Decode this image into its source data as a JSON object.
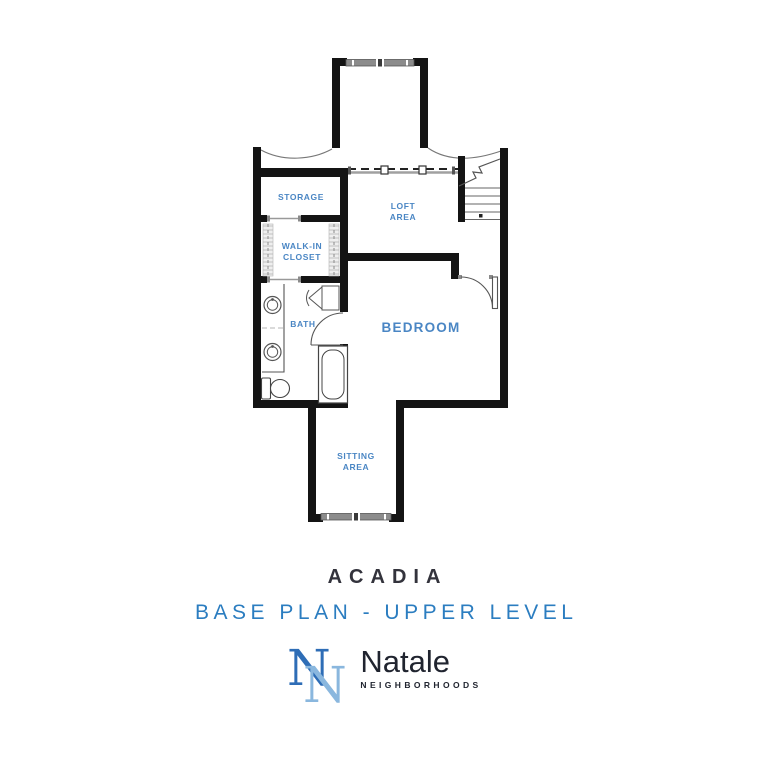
{
  "plan": {
    "rooms": {
      "storage": {
        "label": "STORAGE"
      },
      "loft": {
        "line1": "LOFT",
        "line2": "AREA"
      },
      "walk_in_closet": {
        "line1": "WALK-IN",
        "line2": "CLOSET"
      },
      "bath": {
        "label": "BATH"
      },
      "bedroom": {
        "label": "BEDROOM"
      },
      "sitting": {
        "line1": "SITTING",
        "line2": "AREA"
      }
    }
  },
  "footer": {
    "plan_name": "ACADIA",
    "plan_subtitle": "BASE PLAN - UPPER LEVEL",
    "brand_name": "Natale",
    "brand_tagline": "NEIGHBORHOODS",
    "monogram_letter": "N"
  },
  "colors": {
    "wall_black": "#141414",
    "room_label_blue": "#4a86c4",
    "subtitle_blue": "#2b7dc0",
    "title_dark": "#33333c",
    "brand_dark": "#20242f",
    "monogram_dark": "#2e6db6",
    "monogram_light": "#8ab7de",
    "window_gray": "#8c8c8c"
  }
}
